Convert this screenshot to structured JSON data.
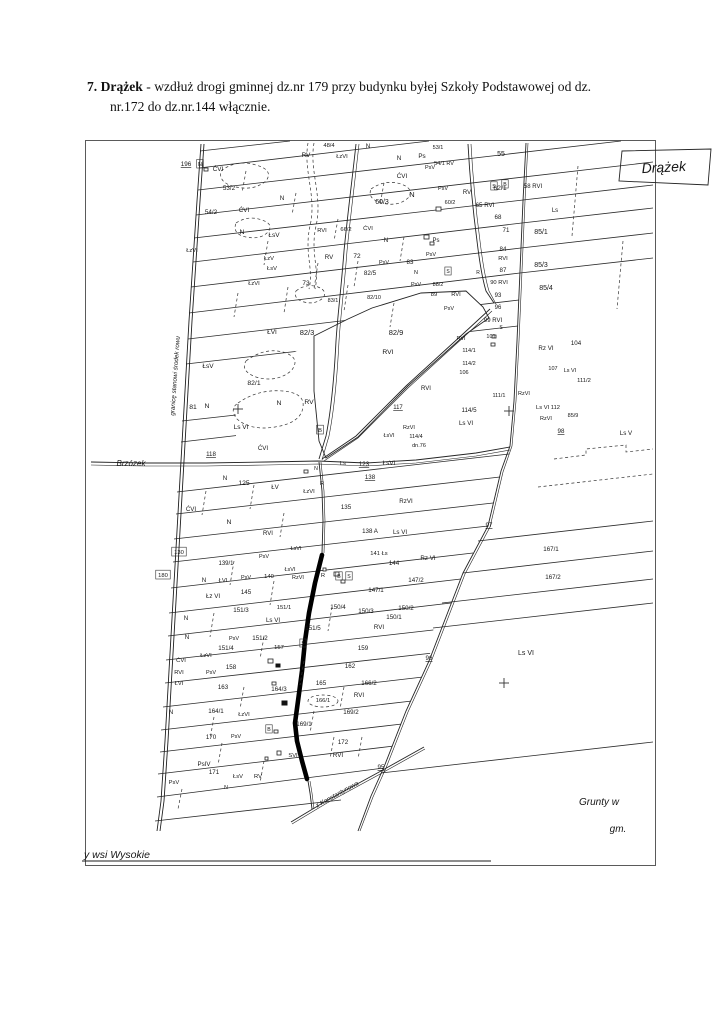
{
  "page": {
    "heading_bold": "7. Drążek",
    "heading_rest": " - wzdłuż drogi gminnej dz.nr 179 przy budynku byłej Szkoły Podstawowej od dz.",
    "heading_line2": "nr.172 do dz.nr.144 włącznie."
  },
  "colors": {
    "ink": "#1d1d1d",
    "paper": "#ffffff",
    "highlight_road": "#000000"
  },
  "map": {
    "labels": [
      {
        "t": "196",
        "x": 100,
        "y": 25,
        "u": 1
      },
      {
        "t": "N",
        "x": 114,
        "y": 25,
        "s": 5.5,
        "box": 1
      },
      {
        "t": "ĆVI",
        "x": 132,
        "y": 30
      },
      {
        "t": "48/4",
        "x": 243,
        "y": 6,
        "s": 5.8
      },
      {
        "t": "N",
        "x": 282,
        "y": 7
      },
      {
        "t": "RV",
        "x": 220,
        "y": 16
      },
      {
        "t": "ŁzVI",
        "x": 256,
        "y": 17,
        "s": 5.8
      },
      {
        "t": "N",
        "x": 313,
        "y": 19
      },
      {
        "t": "Ps",
        "x": 336,
        "y": 17
      },
      {
        "t": "53/1",
        "x": 352,
        "y": 8,
        "s": 5.5
      },
      {
        "t": "55",
        "x": 415,
        "y": 15,
        "s": 7
      },
      {
        "t": "54/1 RV",
        "x": 358,
        "y": 24,
        "s": 5.5
      },
      {
        "t": "PsV",
        "x": 344,
        "y": 28,
        "s": 5.5
      },
      {
        "t": "ĆVI",
        "x": 316,
        "y": 37
      },
      {
        "t": "S",
        "x": 408,
        "y": 47,
        "s": 5.2,
        "box": 1
      },
      {
        "t": "B",
        "x": 419,
        "y": 45,
        "s": 5.2,
        "box": 1
      },
      {
        "t": "58 RVI",
        "x": 447,
        "y": 47,
        "s": 6
      },
      {
        "t": "53/2",
        "x": 143,
        "y": 49
      },
      {
        "t": "N",
        "x": 196,
        "y": 59
      },
      {
        "t": "ĆVI",
        "x": 158,
        "y": 71
      },
      {
        "t": "54/2",
        "x": 125,
        "y": 73
      },
      {
        "t": "60/3",
        "x": 296,
        "y": 63,
        "s": 7
      },
      {
        "t": "N",
        "x": 326,
        "y": 56,
        "s": 7.5
      },
      {
        "t": "PsV",
        "x": 357,
        "y": 49,
        "s": 5.5
      },
      {
        "t": "RV",
        "x": 381,
        "y": 53,
        "s": 6
      },
      {
        "t": "62/1",
        "x": 414,
        "y": 49,
        "s": 6.8
      },
      {
        "t": "60/2",
        "x": 364,
        "y": 63,
        "s": 5.5
      },
      {
        "t": "65 RVI",
        "x": 399,
        "y": 66,
        "s": 6.2
      },
      {
        "t": "Ls",
        "x": 469,
        "y": 71,
        "s": 6
      },
      {
        "t": "N",
        "x": 156,
        "y": 93,
        "s": 6.8
      },
      {
        "t": "ŁsV",
        "x": 188,
        "y": 96,
        "s": 6.5
      },
      {
        "t": "RVI",
        "x": 236,
        "y": 91,
        "s": 5.8
      },
      {
        "t": "66/2",
        "x": 260,
        "y": 90,
        "s": 5.8
      },
      {
        "t": "ĆVI",
        "x": 282,
        "y": 89,
        "s": 5.8
      },
      {
        "t": "ŁzV",
        "x": 183,
        "y": 119,
        "s": 5.8
      },
      {
        "t": "ŁsV",
        "x": 186,
        "y": 129,
        "s": 5.8
      },
      {
        "t": "ŁzVI",
        "x": 106,
        "y": 111,
        "s": 5.8
      },
      {
        "t": "RV",
        "x": 243,
        "y": 118,
        "s": 6.2
      },
      {
        "t": "72",
        "x": 271,
        "y": 117,
        "s": 6.5
      },
      {
        "t": "PsV",
        "x": 298,
        "y": 123,
        "s": 5.5
      },
      {
        "t": "83",
        "x": 324,
        "y": 123,
        "s": 6.2
      },
      {
        "t": "N",
        "x": 330,
        "y": 133,
        "s": 5.5
      },
      {
        "t": "PsV",
        "x": 345,
        "y": 115,
        "s": 5.5
      },
      {
        "t": "Ps",
        "x": 350,
        "y": 101,
        "s": 6
      },
      {
        "t": "N",
        "x": 300,
        "y": 101,
        "s": 6.2
      },
      {
        "t": "ŁzVI",
        "x": 168,
        "y": 144,
        "s": 5.8
      },
      {
        "t": "73",
        "x": 220,
        "y": 144,
        "s": 6.5
      },
      {
        "t": "82/5",
        "x": 284,
        "y": 134,
        "s": 6.3
      },
      {
        "t": "82/10",
        "x": 288,
        "y": 158,
        "s": 5.5
      },
      {
        "t": "83/1",
        "x": 247,
        "y": 161,
        "s": 5.5
      },
      {
        "t": "PsV",
        "x": 330,
        "y": 145,
        "s": 5.5
      },
      {
        "t": "88/2",
        "x": 352,
        "y": 145,
        "s": 5.5
      },
      {
        "t": "89",
        "x": 348,
        "y": 155,
        "s": 5.8
      },
      {
        "t": "RVI",
        "x": 370,
        "y": 155,
        "s": 5.8
      },
      {
        "t": "S",
        "x": 362,
        "y": 132,
        "s": 5,
        "box": 1
      },
      {
        "t": "R",
        "x": 392,
        "y": 133,
        "s": 5
      },
      {
        "t": "87",
        "x": 417,
        "y": 131,
        "s": 6.2
      },
      {
        "t": "84",
        "x": 417,
        "y": 110,
        "s": 6.2
      },
      {
        "t": "RVI",
        "x": 417,
        "y": 119,
        "s": 5.8
      },
      {
        "t": "85/1",
        "x": 455,
        "y": 93,
        "s": 7
      },
      {
        "t": "68",
        "x": 412,
        "y": 78,
        "s": 6.2
      },
      {
        "t": "71",
        "x": 420,
        "y": 91,
        "s": 6.2
      },
      {
        "t": "85/3",
        "x": 455,
        "y": 126,
        "s": 7
      },
      {
        "t": "85/4",
        "x": 460,
        "y": 149,
        "s": 7
      },
      {
        "t": "90 RVI",
        "x": 413,
        "y": 143,
        "s": 5.8
      },
      {
        "t": "93",
        "x": 412,
        "y": 156,
        "s": 6
      },
      {
        "t": "96",
        "x": 412,
        "y": 168,
        "s": 6
      },
      {
        "t": "PsV",
        "x": 363,
        "y": 169,
        "s": 5.5
      },
      {
        "t": "99 RVI",
        "x": 407,
        "y": 181,
        "s": 6
      },
      {
        "t": "S",
        "x": 415,
        "y": 188,
        "s": 5
      },
      {
        "t": "RVI",
        "x": 375,
        "y": 199,
        "s": 5.5
      },
      {
        "t": "101",
        "x": 405,
        "y": 197,
        "s": 5.5
      },
      {
        "t": "114/1",
        "x": 383,
        "y": 211,
        "s": 5.5
      },
      {
        "t": "114/2",
        "x": 383,
        "y": 224,
        "s": 5.5
      },
      {
        "t": "106",
        "x": 378,
        "y": 233,
        "s": 5.5
      },
      {
        "t": "Rz VI",
        "x": 460,
        "y": 209,
        "s": 6.2
      },
      {
        "t": "104",
        "x": 490,
        "y": 204,
        "s": 6.2
      },
      {
        "t": "107",
        "x": 467,
        "y": 229,
        "s": 5.5
      },
      {
        "t": "Ls VI",
        "x": 484,
        "y": 231,
        "s": 5.5
      },
      {
        "t": "111/2",
        "x": 498,
        "y": 241,
        "s": 5.8
      },
      {
        "t": "111/1",
        "x": 413,
        "y": 256,
        "s": 5.5
      },
      {
        "t": "RzVI",
        "x": 438,
        "y": 254,
        "s": 5.5
      },
      {
        "t": "Ls VI 112",
        "x": 462,
        "y": 268,
        "s": 5.8
      },
      {
        "t": "RzVI",
        "x": 460,
        "y": 279,
        "s": 5.5
      },
      {
        "t": "85/9",
        "x": 487,
        "y": 276,
        "s": 5.5
      },
      {
        "t": "98",
        "x": 475,
        "y": 292,
        "u": 1,
        "s": 6.2
      },
      {
        "t": "Ls V",
        "x": 540,
        "y": 294,
        "s": 6.2
      },
      {
        "t": "114/5",
        "x": 383,
        "y": 271,
        "s": 6.2
      },
      {
        "t": "Ls VI",
        "x": 380,
        "y": 284,
        "s": 6.2
      },
      {
        "t": "ŁVI",
        "x": 186,
        "y": 193,
        "s": 6.5
      },
      {
        "t": "82/3",
        "x": 221,
        "y": 194,
        "s": 7.5
      },
      {
        "t": "82/9",
        "x": 310,
        "y": 194,
        "s": 7.5
      },
      {
        "t": "RVI",
        "x": 302,
        "y": 213,
        "s": 6.8
      },
      {
        "t": "82/1",
        "x": 168,
        "y": 244,
        "s": 6.8
      },
      {
        "t": "N",
        "x": 193,
        "y": 264,
        "s": 6.8
      },
      {
        "t": "RV",
        "x": 223,
        "y": 263,
        "s": 6.8
      },
      {
        "t": "B",
        "x": 234,
        "y": 291,
        "s": 5.8,
        "box": 1
      },
      {
        "t": "81",
        "x": 107,
        "y": 268,
        "s": 6.8
      },
      {
        "t": "N",
        "x": 121,
        "y": 267,
        "s": 6.8
      },
      {
        "t": "Ls VI",
        "x": 155,
        "y": 288,
        "s": 6.5
      },
      {
        "t": "ŁsV",
        "x": 122,
        "y": 227,
        "s": 6.5
      },
      {
        "t": "117",
        "x": 312,
        "y": 268,
        "u": 1,
        "s": 6
      },
      {
        "t": "RVI",
        "x": 340,
        "y": 249,
        "s": 6
      },
      {
        "t": "RzVI",
        "x": 323,
        "y": 288,
        "s": 5.5
      },
      {
        "t": "ŁsVI",
        "x": 303,
        "y": 296,
        "s": 5.5
      },
      {
        "t": "114/4",
        "x": 330,
        "y": 297,
        "s": 5.5
      },
      {
        "t": "dn.76",
        "x": 333,
        "y": 306,
        "s": 5.5
      },
      {
        "t": "118",
        "x": 125,
        "y": 315,
        "u": 1,
        "s": 6.2
      },
      {
        "n": "village-brzozek",
        "t": "Brzózek",
        "x": 45,
        "y": 325,
        "s": 8,
        "i": 1
      },
      {
        "t": "ĆVI",
        "x": 177,
        "y": 309,
        "s": 6.2
      },
      {
        "t": "N",
        "x": 230,
        "y": 329,
        "s": 5.2
      },
      {
        "t": "Ls",
        "x": 257,
        "y": 324,
        "s": 5.8
      },
      {
        "t": "123",
        "x": 278,
        "y": 325,
        "u": 1,
        "s": 6.2
      },
      {
        "t": "ŁsVI",
        "x": 303,
        "y": 324,
        "s": 6.2
      },
      {
        "t": "N",
        "x": 139,
        "y": 339,
        "s": 6.2
      },
      {
        "t": "125",
        "x": 158,
        "y": 344,
        "s": 6.8
      },
      {
        "t": "ŁV",
        "x": 189,
        "y": 348,
        "s": 6.2
      },
      {
        "t": "ŁzVI",
        "x": 223,
        "y": 352,
        "s": 5.8
      },
      {
        "t": "R",
        "x": 236,
        "y": 344,
        "s": 5.8
      },
      {
        "t": "138",
        "x": 284,
        "y": 338,
        "u": 1,
        "s": 6.2
      },
      {
        "t": "RzVI",
        "x": 320,
        "y": 362,
        "s": 6.2
      },
      {
        "t": "135",
        "x": 260,
        "y": 368,
        "s": 6.2
      },
      {
        "t": "ĆVI",
        "x": 105,
        "y": 370,
        "s": 6.2
      },
      {
        "t": "N",
        "x": 143,
        "y": 383,
        "s": 6.8
      },
      {
        "t": "130",
        "x": 93,
        "y": 413,
        "s": 5.8,
        "box": 1
      },
      {
        "t": "180",
        "x": 77,
        "y": 436,
        "s": 5.8,
        "box": 1
      },
      {
        "t": "139/1",
        "x": 140,
        "y": 424,
        "s": 6
      },
      {
        "t": "PsV",
        "x": 178,
        "y": 417,
        "s": 5.5
      },
      {
        "t": "RVI",
        "x": 182,
        "y": 394,
        "s": 6
      },
      {
        "t": "ŁsVI",
        "x": 210,
        "y": 409,
        "s": 5.5
      },
      {
        "t": "138 A",
        "x": 284,
        "y": 392,
        "s": 6.2
      },
      {
        "t": "Ls VI",
        "x": 314,
        "y": 393,
        "s": 6.2
      },
      {
        "t": "141 Łs",
        "x": 293,
        "y": 414,
        "s": 5.8
      },
      {
        "t": "Rz VI",
        "x": 342,
        "y": 419,
        "s": 6.2
      },
      {
        "t": "144",
        "x": 308,
        "y": 424,
        "s": 6.2
      },
      {
        "t": "147/2",
        "x": 330,
        "y": 441,
        "s": 6.2
      },
      {
        "t": "R",
        "x": 237,
        "y": 436,
        "s": 5.8
      },
      {
        "t": "B",
        "x": 253,
        "y": 437,
        "s": 5.2,
        "box": 1
      },
      {
        "t": "S",
        "x": 263,
        "y": 437,
        "s": 5.2,
        "box": 1
      },
      {
        "t": "147/1",
        "x": 290,
        "y": 451,
        "s": 6.2
      },
      {
        "t": "150/2",
        "x": 320,
        "y": 469,
        "s": 6.2
      },
      {
        "t": "150/3",
        "x": 280,
        "y": 472,
        "s": 6.2
      },
      {
        "t": "150/4",
        "x": 252,
        "y": 468,
        "s": 6.2
      },
      {
        "t": "150/1",
        "x": 308,
        "y": 478,
        "s": 6.2
      },
      {
        "t": "151/5",
        "x": 227,
        "y": 489,
        "s": 6.2
      },
      {
        "t": "RVI",
        "x": 293,
        "y": 488,
        "s": 6.2
      },
      {
        "t": "159",
        "x": 277,
        "y": 509,
        "s": 6.2
      },
      {
        "t": "162",
        "x": 264,
        "y": 527,
        "s": 6.2
      },
      {
        "t": "96",
        "x": 343,
        "y": 519,
        "u": 1,
        "s": 6.2
      },
      {
        "t": "97",
        "x": 403,
        "y": 386,
        "u": 1,
        "s": 6.2
      },
      {
        "t": "167/1",
        "x": 465,
        "y": 410,
        "s": 6.2
      },
      {
        "t": "167/2",
        "x": 467,
        "y": 438,
        "s": 6.2
      },
      {
        "t": "Ls VI",
        "x": 440,
        "y": 514,
        "s": 7
      },
      {
        "t": "Łz VI",
        "x": 127,
        "y": 457,
        "s": 6.2
      },
      {
        "t": "145",
        "x": 160,
        "y": 453,
        "s": 6.2
      },
      {
        "t": "N",
        "x": 118,
        "y": 441,
        "s": 6.2
      },
      {
        "t": "ŁVI",
        "x": 137,
        "y": 441,
        "s": 5.8
      },
      {
        "t": "PsV",
        "x": 160,
        "y": 438,
        "s": 5.5
      },
      {
        "t": "140",
        "x": 183,
        "y": 437,
        "s": 5.8
      },
      {
        "t": "ŁsVI",
        "x": 204,
        "y": 430,
        "s": 5.5
      },
      {
        "t": "RzVI",
        "x": 212,
        "y": 438,
        "s": 5.5
      },
      {
        "t": "151/3",
        "x": 155,
        "y": 471,
        "s": 6.2
      },
      {
        "t": "151/1",
        "x": 198,
        "y": 468,
        "s": 5.8
      },
      {
        "t": "N",
        "x": 100,
        "y": 479,
        "s": 6.2
      },
      {
        "t": "Ls VI",
        "x": 187,
        "y": 481,
        "s": 6.2
      },
      {
        "t": "N",
        "x": 101,
        "y": 498,
        "s": 6.2
      },
      {
        "t": "PsV",
        "x": 148,
        "y": 499,
        "s": 5.5
      },
      {
        "t": "151/2",
        "x": 174,
        "y": 499,
        "s": 6.2
      },
      {
        "t": "151/4",
        "x": 140,
        "y": 509,
        "s": 6.2
      },
      {
        "t": "157",
        "x": 193,
        "y": 508,
        "s": 5.8
      },
      {
        "t": "S",
        "x": 217,
        "y": 504,
        "s": 5,
        "box": 1
      },
      {
        "t": "ĆVI",
        "x": 95,
        "y": 521,
        "s": 5.8
      },
      {
        "t": "ŁzVI",
        "x": 120,
        "y": 516,
        "s": 5.8
      },
      {
        "t": "RVI",
        "x": 93,
        "y": 533,
        "s": 5.8
      },
      {
        "t": "PsV",
        "x": 125,
        "y": 533,
        "s": 5.5
      },
      {
        "t": "158",
        "x": 145,
        "y": 528,
        "s": 6.2
      },
      {
        "t": "ŁVI",
        "x": 93,
        "y": 544,
        "s": 5.8
      },
      {
        "t": "163",
        "x": 137,
        "y": 548,
        "s": 6.2
      },
      {
        "t": "164/3",
        "x": 193,
        "y": 550,
        "s": 6.2
      },
      {
        "t": "165",
        "x": 235,
        "y": 544,
        "s": 6.2
      },
      {
        "t": "166/2",
        "x": 283,
        "y": 544,
        "s": 6.2
      },
      {
        "t": "166/1",
        "x": 237,
        "y": 561,
        "s": 5.8
      },
      {
        "t": "RVI",
        "x": 273,
        "y": 556,
        "s": 6.2
      },
      {
        "t": "N",
        "x": 85,
        "y": 573,
        "s": 6.2
      },
      {
        "t": "164/1",
        "x": 130,
        "y": 572,
        "s": 6.2
      },
      {
        "t": "ŁzVI",
        "x": 158,
        "y": 575,
        "s": 5.8
      },
      {
        "t": "169/2",
        "x": 265,
        "y": 573,
        "s": 6.2
      },
      {
        "t": "169/1",
        "x": 218,
        "y": 585,
        "s": 6.2
      },
      {
        "t": "B",
        "x": 183,
        "y": 590,
        "s": 5.2,
        "box": 1
      },
      {
        "t": "170",
        "x": 125,
        "y": 598,
        "s": 6.2
      },
      {
        "t": "PsV",
        "x": 150,
        "y": 597,
        "s": 5.5
      },
      {
        "t": "172",
        "x": 257,
        "y": 603,
        "s": 6.2
      },
      {
        "t": "RVI",
        "x": 252,
        "y": 616,
        "s": 6.2
      },
      {
        "t": "SVI",
        "x": 207,
        "y": 616,
        "s": 5.8
      },
      {
        "t": "PsIV",
        "x": 118,
        "y": 625,
        "s": 6.2
      },
      {
        "t": "171",
        "x": 128,
        "y": 633,
        "s": 6.2
      },
      {
        "t": "ŁsV",
        "x": 152,
        "y": 637,
        "s": 5.8
      },
      {
        "t": "RV",
        "x": 172,
        "y": 637,
        "s": 5.8
      },
      {
        "t": "PsV",
        "x": 88,
        "y": 643,
        "s": 5.8
      },
      {
        "t": "N",
        "x": 140,
        "y": 648,
        "s": 5.2
      },
      {
        "t": "95",
        "x": 295,
        "y": 628,
        "u": 1,
        "s": 6.2
      },
      {
        "n": "road-name-konstantynowa",
        "t": "z Konstantynowa",
        "x": 252,
        "y": 655,
        "s": 6.3,
        "i": 1,
        "r": -29
      },
      {
        "n": "boundary-note",
        "t": "granicę stanowi środek rowu",
        "x": 91,
        "y": 235,
        "s": 6.3,
        "i": 1,
        "r": -86
      },
      {
        "n": "map-title-handwritten",
        "t": "Drążek",
        "x": 578,
        "y": 31,
        "s": 14,
        "i": 1,
        "r": -3
      },
      {
        "n": "note-grunty",
        "t": "Grunty w",
        "x": 513,
        "y": 664,
        "s": 10,
        "i": 1
      },
      {
        "n": "note-gm",
        "t": "gm.",
        "x": 532,
        "y": 691,
        "s": 10,
        "i": 1
      },
      {
        "n": "bottom-note",
        "t": "y   wsi  Wysokie",
        "x": -2,
        "y": 717,
        "s": 10.5,
        "i": 1,
        "a": "s"
      }
    ]
  }
}
